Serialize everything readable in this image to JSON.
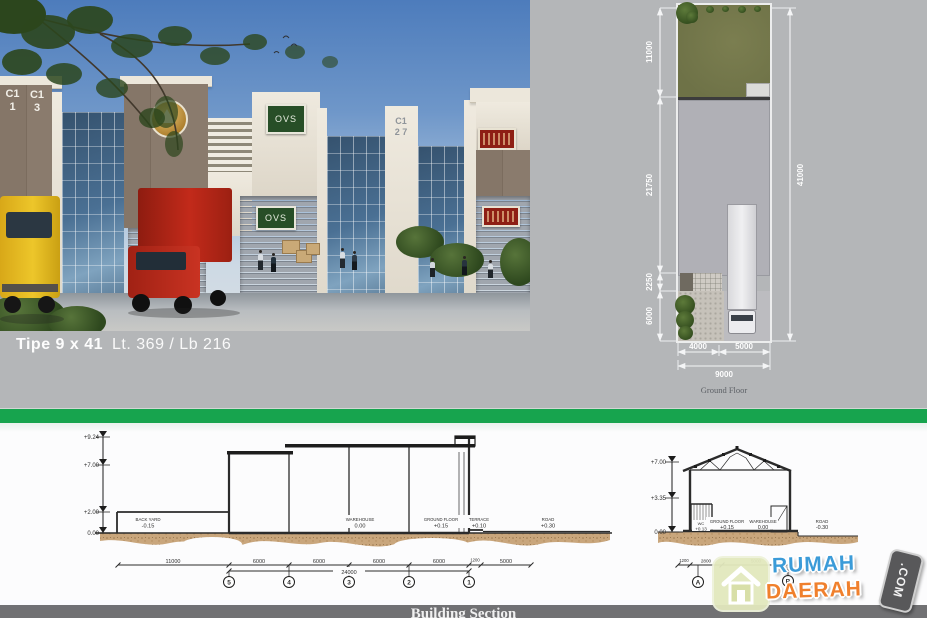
{
  "colors": {
    "green_bar": "#17a44e",
    "footer_gray": "#717173",
    "background_gray": "#b4b6b8",
    "logo_blue": "#3b9bd8",
    "logo_orange": "#f0802d"
  },
  "caption": {
    "type_label": "Tipe 9 x 41",
    "area_label": "Lt. 369 / Lb 216"
  },
  "render_signs": {
    "unit_a": "C1\n1",
    "unit_b": "C1\n3",
    "ovs_upper": "OVS",
    "ovs_door": "OVS",
    "unit_c": "C1\n2 7"
  },
  "site_plan": {
    "side_dims": [
      "11000",
      "21750",
      "2250",
      "6000"
    ],
    "height_dim": "41000",
    "bottom_dims": [
      "4000",
      "5000"
    ],
    "bottom_total": "9000",
    "label": "Ground Floor"
  },
  "section_long": {
    "elevations": [
      "+9.24",
      "+7.00",
      "+2.00",
      "0.00"
    ],
    "floor_labels": [
      {
        "name": "BACK YARD",
        "value": "-0.15"
      },
      {
        "name": "WAREHOUSE",
        "value": "0.00"
      },
      {
        "name": "GROUND FLOOR",
        "value": "+0.15"
      },
      {
        "name": "TERRACE",
        "value": "+0.10"
      },
      {
        "name": "ROAD",
        "value": "+0.30"
      }
    ],
    "dims": [
      "11000",
      "6000",
      "6000",
      "6000",
      "6000",
      "1200",
      "5000"
    ],
    "dim_total": "24000",
    "grid_bubbles": [
      "5",
      "4",
      "3",
      "2",
      "1"
    ]
  },
  "section_cross": {
    "elevations": [
      "+7.00",
      "+3.35",
      "0.00"
    ],
    "floor_labels": [
      {
        "name": "WC",
        "value": "+0.13"
      },
      {
        "name": "GROUND FLOOR",
        "value": "+0.15"
      },
      {
        "name": "WAREHOUSE",
        "value": "0.00"
      },
      {
        "name": "ROAD",
        "value": "-0.30"
      }
    ],
    "dims": [
      "1200",
      "2800",
      "5000"
    ],
    "grid_bubbles": [
      "A",
      "B"
    ]
  },
  "footer": {
    "title": "Building Section"
  },
  "logo": {
    "word1": "RUMAH",
    "word2": "DAERAH",
    "tag": ".COM"
  }
}
